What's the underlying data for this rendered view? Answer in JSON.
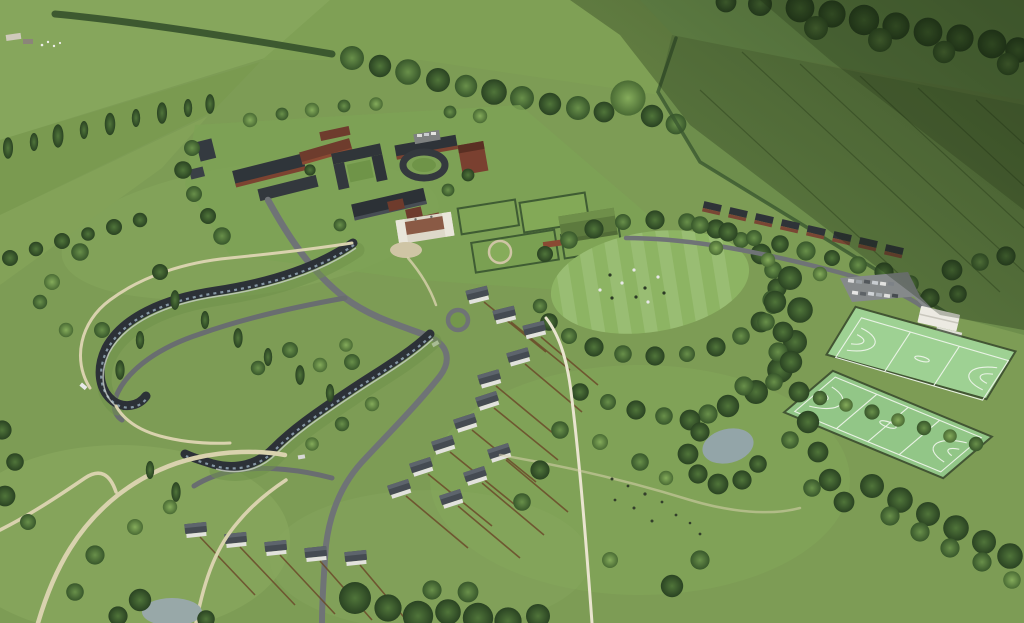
{
  "scene": {
    "type": "aerial-cgi-render",
    "subject": "Rural residential masterplan: school campus with manor house, cricket oval ringed by trees, two all-weather sports courts with pavilion and car park, crescent terraces, detached housing, winding footpaths, ponds and farmland"
  },
  "features": [
    "farmland-patchwork",
    "cloud-shadow",
    "woodland-belts",
    "campus-buildings",
    "manor-house",
    "formal-gardens",
    "green-roof-hall",
    "oval-playing-field",
    "players",
    "north-east-lane",
    "lane-houses",
    "car-park",
    "pavilion",
    "upper-court",
    "lower-court",
    "pond",
    "housing-crescents",
    "detached-houses",
    "garden-fences",
    "footpaths",
    "grazing-animals"
  ],
  "palette": {
    "meadow": "#7d9c55",
    "meadow_light": "#8dac61",
    "field_pale": "#84a35b",
    "field_arable": "#6e8e4c",
    "woodland_dark": "#2d4824",
    "tree_mid": "#3f6030",
    "tree_light": "#57823c",
    "pitch_green": "#8db463",
    "court_green": "#9ed193",
    "court_green_dark": "#92c687",
    "court_line": "#eef5ea",
    "path": "#d9d2ae",
    "road": "#6f7376",
    "road_dark": "#585c5e",
    "parking_grey": "#85898a",
    "roof_dark": "#2f353a",
    "roof_grey": "#4c525a",
    "brick_red": "#7c4331",
    "roof_red": "#713e2d",
    "wall_white": "#e8e5da",
    "green_roof": "#5d7a3e",
    "fence_brown": "#6b4a2a",
    "water": "#93a5a8",
    "shadow_green": "#16240f"
  }
}
